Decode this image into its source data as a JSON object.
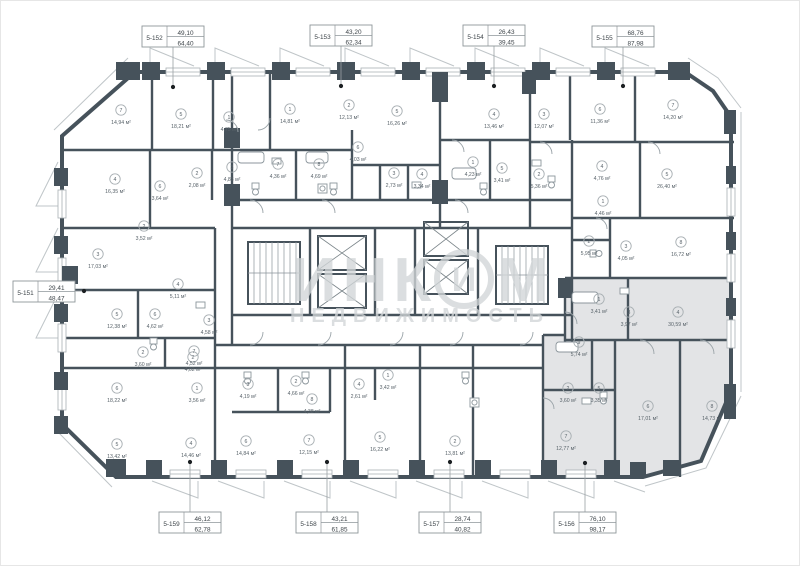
{
  "plan_title": "floor-plan",
  "area_unit": "м²",
  "colors": {
    "wall": "#46525b",
    "facade_line": "#bfc5c8",
    "highlight_fill": "#e3e4e6",
    "label_text": "#59636a",
    "watermark": "#d2d6d8",
    "leader": "#9aa0a4",
    "dot": "#1b1f22"
  },
  "watermark": {
    "line1_left": "ИНК",
    "line1_right": "М",
    "logo_letter": "И",
    "line2": "НЕДВИЖИМОСТЬ"
  },
  "units": [
    {
      "id": "5-151",
      "a1": "29,41",
      "a2": "48,47",
      "box": [
        13,
        281
      ],
      "leader": [
        75,
        291,
        84,
        291
      ],
      "dot": [
        84,
        291
      ]
    },
    {
      "id": "5-152",
      "a1": "49,10",
      "a2": "64,40",
      "box": [
        142,
        26
      ],
      "leader": [
        173,
        47,
        173,
        87
      ],
      "dot": [
        173,
        87
      ]
    },
    {
      "id": "5-153",
      "a1": "43,20",
      "a2": "62,34",
      "box": [
        310,
        25
      ],
      "leader": [
        341,
        46,
        341,
        86
      ],
      "dot": [
        341,
        86
      ]
    },
    {
      "id": "5-154",
      "a1": "26,43",
      "a2": "39,45",
      "box": [
        463,
        25
      ],
      "leader": [
        494,
        46,
        494,
        86
      ],
      "dot": [
        494,
        86
      ]
    },
    {
      "id": "5-155",
      "a1": "68,76",
      "a2": "87,98",
      "box": [
        592,
        26
      ],
      "leader": [
        623,
        47,
        623,
        86
      ],
      "dot": [
        623,
        86
      ]
    },
    {
      "id": "5-156",
      "a1": "76,10",
      "a2": "98,17",
      "box": [
        554,
        512
      ],
      "leader": [
        585,
        463,
        585,
        512
      ],
      "dot": [
        585,
        463
      ]
    },
    {
      "id": "5-157",
      "a1": "28,74",
      "a2": "40,82",
      "box": [
        419,
        512
      ],
      "leader": [
        450,
        462,
        450,
        512
      ],
      "dot": [
        450,
        462
      ]
    },
    {
      "id": "5-158",
      "a1": "43,21",
      "a2": "61,85",
      "box": [
        296,
        512
      ],
      "leader": [
        327,
        462,
        327,
        512
      ],
      "dot": [
        327,
        462
      ]
    },
    {
      "id": "5-159",
      "a1": "46,12",
      "a2": "62,78",
      "box": [
        159,
        512
      ],
      "leader": [
        190,
        462,
        190,
        512
      ],
      "dot": [
        190,
        462
      ]
    }
  ],
  "rooms": [
    [
      7,
      "14,94",
      121,
      110
    ],
    [
      5,
      "18,21",
      181,
      114
    ],
    [
      1,
      "4,75",
      229,
      117
    ],
    [
      4,
      "16,35",
      115,
      179
    ],
    [
      2,
      "2,08",
      197,
      173
    ],
    [
      3,
      "4,83",
      232,
      167
    ],
    [
      6,
      "3,64",
      160,
      186
    ],
    [
      2,
      "3,52",
      144,
      226
    ],
    [
      1,
      "14,81",
      290,
      109
    ],
    [
      2,
      "12,13",
      349,
      105
    ],
    [
      5,
      "16,26",
      397,
      111
    ],
    [
      6,
      "4,03",
      358,
      147
    ],
    [
      7,
      "4,36",
      278,
      164
    ],
    [
      8,
      "4,69",
      319,
      164
    ],
    [
      3,
      "2,73",
      394,
      173
    ],
    [
      4,
      "3,34",
      422,
      174
    ],
    [
      4,
      "13,46",
      494,
      114
    ],
    [
      1,
      "4,23",
      473,
      162
    ],
    [
      5,
      "3,41",
      502,
      168
    ],
    [
      3,
      "12,07",
      544,
      114
    ],
    [
      6,
      "11,36",
      600,
      109
    ],
    [
      7,
      "14,20",
      673,
      105
    ],
    [
      2,
      "5,36",
      539,
      174
    ],
    [
      4,
      "4,76",
      602,
      166
    ],
    [
      5,
      "26,40",
      667,
      174
    ],
    [
      1,
      "4,46",
      603,
      201
    ],
    [
      2,
      "5,95",
      589,
      241
    ],
    [
      3,
      "4,05",
      626,
      246
    ],
    [
      8,
      "16,72",
      681,
      242
    ],
    [
      1,
      "3,41",
      599,
      299
    ],
    [
      3,
      "3,97",
      629,
      312
    ],
    [
      4,
      "30,59",
      678,
      312
    ],
    [
      9,
      "5,74",
      579,
      342
    ],
    [
      2,
      "3,60",
      568,
      388
    ],
    [
      5,
      "3,35",
      599,
      388
    ],
    [
      7,
      "12,77",
      566,
      436
    ],
    [
      6,
      "17,01",
      648,
      406
    ],
    [
      8,
      "14,73",
      712,
      406
    ],
    [
      4,
      "14,46",
      191,
      443
    ],
    [
      6,
      "14,84",
      246,
      441
    ],
    [
      7,
      "12,15",
      309,
      440
    ],
    [
      5,
      "16,22",
      380,
      437
    ],
    [
      3,
      "4,19",
      248,
      384
    ],
    [
      2,
      "4,66",
      296,
      381
    ],
    [
      8,
      "4,38",
      312,
      399
    ],
    [
      4,
      "2,61",
      359,
      384
    ],
    [
      1,
      "3,42",
      388,
      375
    ],
    [
      2,
      "4,02",
      193,
      357
    ],
    [
      2,
      "13,81",
      455,
      441
    ],
    [
      3,
      "17,03",
      98,
      254
    ],
    [
      5,
      "12,38",
      117,
      314
    ],
    [
      6,
      "4,62",
      155,
      314
    ],
    [
      2,
      "3,60",
      143,
      352
    ],
    [
      7,
      "4,52",
      194,
      351
    ],
    [
      1,
      "3,56",
      197,
      388
    ],
    [
      6,
      "18,22",
      117,
      388
    ],
    [
      5,
      "13,42",
      117,
      444
    ],
    [
      3,
      "4,58",
      209,
      320
    ],
    [
      4,
      "5,11",
      178,
      284
    ]
  ]
}
